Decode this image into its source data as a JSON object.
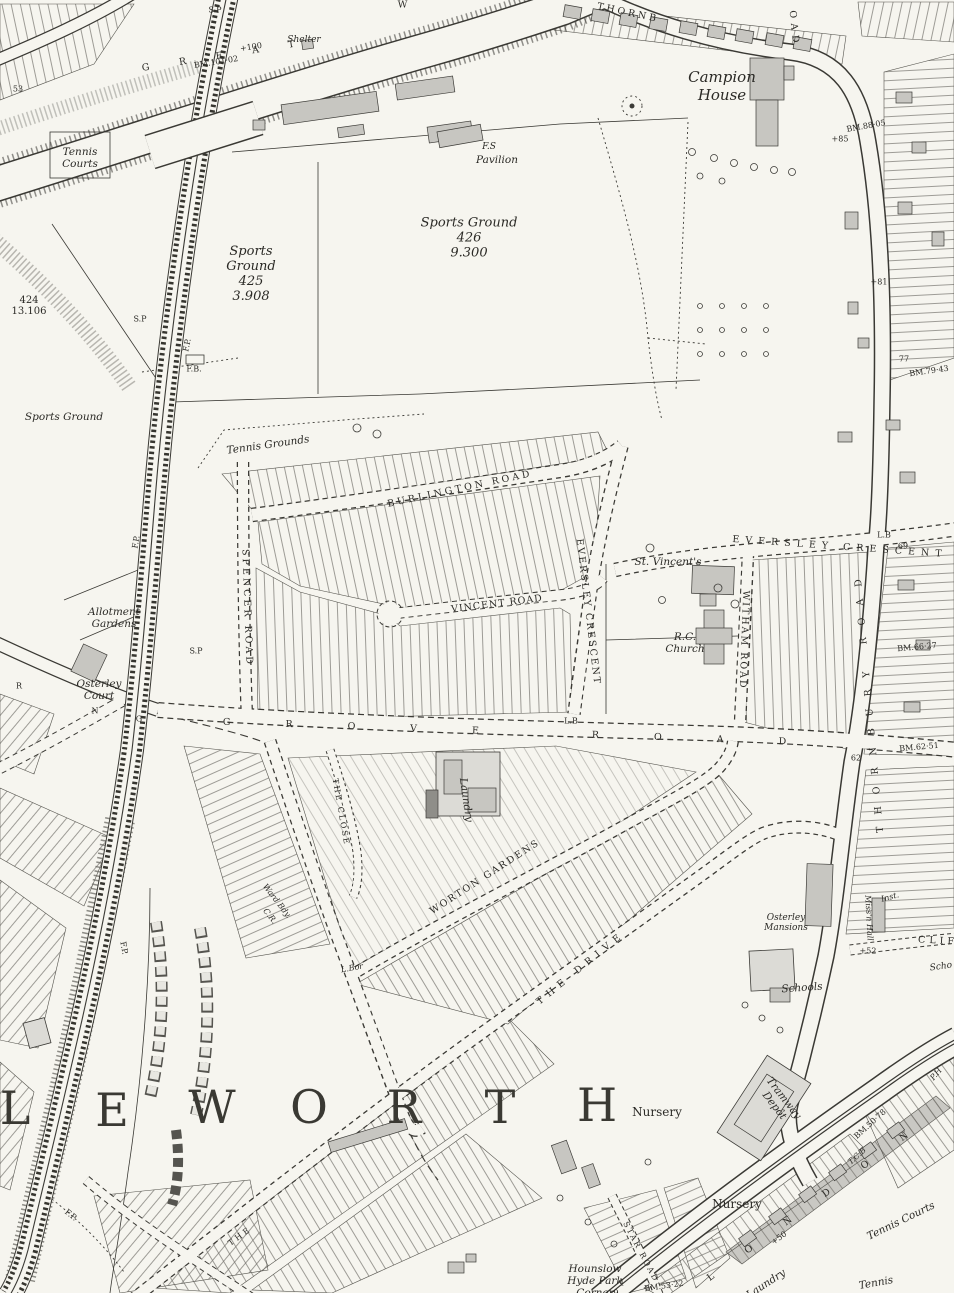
{
  "meta": {
    "kind": "historic-ordnance-survey-map",
    "area": "Isleworth / Osterley, Middlesex",
    "colors": {
      "paper": "#f6f5ef",
      "ink": "#33322e",
      "building_grey": "#c7c6c1",
      "building_light": "#dcdbd6",
      "plot_stripe": "#77756f"
    }
  },
  "labels": [
    {
      "id": "sp-top",
      "t": "S.P",
      "x": 215,
      "y": 10,
      "c": "sm"
    },
    {
      "id": "shelter",
      "t": "Shelter",
      "x": 304,
      "y": 40,
      "c": "itsm"
    },
    {
      "id": "great-west-road",
      "t": "GREAT",
      "x": 233,
      "y": 54,
      "r": -9,
      "c": "rd",
      "ls": 30
    },
    {
      "id": "great-west-road-w",
      "t": "W",
      "x": 404,
      "y": 5,
      "c": "rd"
    },
    {
      "id": "bm-101-02",
      "t": "BM.101·02",
      "x": 216,
      "y": 62,
      "r": -9,
      "c": "sm"
    },
    {
      "id": "spot-100",
      "t": "+100",
      "x": 251,
      "y": 47,
      "r": -9,
      "c": "sm"
    },
    {
      "id": "spot-53",
      "t": "53",
      "x": 18,
      "y": 89,
      "c": "sm"
    },
    {
      "id": "tennis-courts-nw",
      "t": "Tennis\nCourts",
      "x": 80,
      "y": 158,
      "c": "it"
    },
    {
      "id": "thornbury-road-top",
      "t": "THORNB",
      "x": 628,
      "y": 13,
      "r": 12,
      "c": "rd",
      "ls": 3
    },
    {
      "id": "campion-house",
      "t": "Campion\nHouse",
      "x": 722,
      "y": 86,
      "c": "itxl"
    },
    {
      "id": "thornbury-road-oad",
      "t": "OAD",
      "x": 794,
      "y": 29,
      "r": 84,
      "c": "rd",
      "ls": 5
    },
    {
      "id": "bm-88-05",
      "t": "BM.88·05",
      "x": 866,
      "y": 126,
      "r": -10,
      "c": "sm"
    },
    {
      "id": "spot-85",
      "t": "+85",
      "x": 840,
      "y": 139,
      "c": "sm"
    },
    {
      "id": "fs",
      "t": "F.S",
      "x": 489,
      "y": 147,
      "c": "itsm"
    },
    {
      "id": "pavilion",
      "t": "Pavilion",
      "x": 497,
      "y": 160,
      "c": "it"
    },
    {
      "id": "sports-ground-426",
      "t": "Sports Ground\n426\n9.300",
      "x": 469,
      "y": 238,
      "c": "itlg"
    },
    {
      "id": "sports-ground-425",
      "t": "Sports\nGround\n425\n3.908",
      "x": 251,
      "y": 274,
      "c": "itlg"
    },
    {
      "id": "parcel-424",
      "t": "424\n13.106",
      "x": 29,
      "y": 306,
      "c": "bksm"
    },
    {
      "id": "sp-rail",
      "t": "S.P",
      "x": 140,
      "y": 319,
      "c": "sm"
    },
    {
      "id": "fp-rail",
      "t": "F.P.",
      "x": 187,
      "y": 345,
      "r": -78,
      "c": "sm"
    },
    {
      "id": "fb-rail",
      "t": "F.B.",
      "x": 194,
      "y": 369,
      "c": "sm"
    },
    {
      "id": "spot-81",
      "t": "+81",
      "x": 879,
      "y": 282,
      "c": "sm"
    },
    {
      "id": "spot-77",
      "t": "77",
      "x": 904,
      "y": 359,
      "c": "sm"
    },
    {
      "id": "bm-79-43",
      "t": "BM.79·43",
      "x": 929,
      "y": 371,
      "r": -8,
      "c": "sm"
    },
    {
      "id": "sports-ground-w",
      "t": "Sports Ground",
      "x": 64,
      "y": 417,
      "c": "it"
    },
    {
      "id": "fp-rail-2",
      "t": "F.P.",
      "x": 136,
      "y": 542,
      "r": -80,
      "c": "sm"
    },
    {
      "id": "tennis-grounds",
      "t": "Tennis Grounds",
      "x": 268,
      "y": 445,
      "r": -8,
      "c": "it"
    },
    {
      "id": "burlington-road",
      "t": "BURLINGTON ROAD",
      "x": 460,
      "y": 489,
      "r": -12,
      "c": "rd",
      "ls": 3
    },
    {
      "id": "spencer-road",
      "t": "SPENCER ROAD",
      "x": 247,
      "y": 608,
      "r": 88,
      "c": "rd",
      "ls": 3
    },
    {
      "id": "vincent-road",
      "t": "VINCENT ROAD",
      "x": 497,
      "y": 604,
      "r": -7,
      "c": "rd",
      "ls": 1
    },
    {
      "id": "eversley-crescent-w",
      "t": "EVERSLEY CRESCENT",
      "x": 588,
      "y": 612,
      "r": 83,
      "c": "rd",
      "ls": 2
    },
    {
      "id": "st-vincents",
      "t": "St. Vincent's",
      "x": 668,
      "y": 562,
      "c": "it"
    },
    {
      "id": "eversley-crescent-e",
      "t": "EVERSLEY CRESCENT",
      "x": 840,
      "y": 547,
      "r": 4,
      "c": "rd",
      "ls": 6
    },
    {
      "id": "lb-crescent",
      "t": "L.B",
      "x": 884,
      "y": 535,
      "c": "sm"
    },
    {
      "id": "spot-69",
      "t": "69",
      "x": 903,
      "y": 546,
      "c": "sm"
    },
    {
      "id": "witham-road",
      "t": "WITHAM ROAD",
      "x": 744,
      "y": 640,
      "r": 92,
      "c": "rd",
      "ls": 2
    },
    {
      "id": "rc-church",
      "t": "R.C.\nChurch",
      "x": 685,
      "y": 643,
      "c": "it"
    },
    {
      "id": "bm-66-27",
      "t": "BM.66·27",
      "x": 917,
      "y": 647,
      "r": -5,
      "c": "sm"
    },
    {
      "id": "thornbury-road",
      "t": "THORNBURY ROAD",
      "x": 869,
      "y": 700,
      "r": -95,
      "c": "rd",
      "ls": 12
    },
    {
      "id": "grove-road",
      "t": "GROVE ROAD",
      "x": 532,
      "y": 733,
      "r": 2,
      "c": "rd",
      "ls": 55
    },
    {
      "id": "lb-grove",
      "t": "L.B",
      "x": 571,
      "y": 721,
      "c": "sm"
    },
    {
      "id": "sp-grove",
      "t": "S.P",
      "x": 196,
      "y": 651,
      "c": "sm"
    },
    {
      "id": "the-close",
      "t": "THE CLOSE",
      "x": 341,
      "y": 812,
      "r": 80,
      "c": "rdsm",
      "ls": 2
    },
    {
      "id": "laundry",
      "t": "Laundry",
      "x": 466,
      "y": 800,
      "r": 82,
      "c": "it"
    },
    {
      "id": "allotment-gardens",
      "t": "Allotment\nGardens",
      "x": 114,
      "y": 618,
      "c": "it"
    },
    {
      "id": "osterley-court",
      "t": "Osterley\nCourt",
      "x": 99,
      "y": 690,
      "c": "it"
    },
    {
      "id": "ward-bdy",
      "t": "Ward Bdy.",
      "x": 277,
      "y": 901,
      "r": 52,
      "c": "smi"
    },
    {
      "id": "cr",
      "t": "C.R.",
      "x": 270,
      "y": 916,
      "r": 52,
      "c": "smi"
    },
    {
      "id": "l-bor",
      "t": "L.Bor",
      "x": 352,
      "y": 968,
      "r": -10,
      "c": "smi"
    },
    {
      "id": "worton-gardens",
      "t": "WORTON GARDENS",
      "x": 485,
      "y": 877,
      "r": -33,
      "c": "rd",
      "ls": 2
    },
    {
      "id": "the-drive",
      "t": "THE DRIVE",
      "x": 581,
      "y": 968,
      "r": -39,
      "c": "rd",
      "ls": 6
    },
    {
      "id": "the-drive-sw",
      "t": "THE",
      "x": 240,
      "y": 1236,
      "r": -36,
      "c": "rdsm",
      "ls": 3
    },
    {
      "id": "district-l",
      "t": "L",
      "x": 15,
      "y": 1108,
      "c": "hg"
    },
    {
      "id": "district-e",
      "t": "E",
      "x": 112,
      "y": 1110,
      "c": "hg"
    },
    {
      "id": "district-w",
      "t": "W",
      "x": 212,
      "y": 1107,
      "c": "hg"
    },
    {
      "id": "district-o",
      "t": "O",
      "x": 309,
      "y": 1107,
      "c": "hg"
    },
    {
      "id": "district-r",
      "t": "R",
      "x": 404,
      "y": 1107,
      "c": "hg"
    },
    {
      "id": "district-t",
      "t": "T",
      "x": 500,
      "y": 1107,
      "c": "hg"
    },
    {
      "id": "district-h",
      "t": "H",
      "x": 597,
      "y": 1105,
      "c": "hg"
    },
    {
      "id": "nursery-n",
      "t": "Nursery",
      "x": 657,
      "y": 1112,
      "c": "bk"
    },
    {
      "id": "tramway-depot",
      "t": "Tramway\nDepôt",
      "x": 779,
      "y": 1102,
      "r": 52,
      "c": "it"
    },
    {
      "id": "nursery-s",
      "t": "Nursery",
      "x": 737,
      "y": 1204,
      "c": "bk"
    },
    {
      "id": "schools",
      "t": "Schools",
      "x": 802,
      "y": 988,
      "r": -4,
      "c": "it"
    },
    {
      "id": "osterley-mansions",
      "t": "Osterley\nMansions",
      "x": 786,
      "y": 923,
      "c": "itsm"
    },
    {
      "id": "missn-hall",
      "t": "Miss'n Hall",
      "x": 869,
      "y": 918,
      "r": 87,
      "c": "smi"
    },
    {
      "id": "inst",
      "t": "Inst.",
      "x": 890,
      "y": 897,
      "r": -15,
      "c": "smi"
    },
    {
      "id": "clifton-road",
      "t": "CLIF",
      "x": 938,
      "y": 941,
      "r": 3,
      "c": "rd",
      "ls": 4
    },
    {
      "id": "school-e",
      "t": "Scho",
      "x": 941,
      "y": 967,
      "r": -8,
      "c": "itsm"
    },
    {
      "id": "spot-52",
      "t": "+52",
      "x": 868,
      "y": 951,
      "c": "sm"
    },
    {
      "id": "bm-62-51",
      "t": "BM.62·51",
      "x": 919,
      "y": 747,
      "r": -5,
      "c": "sm"
    },
    {
      "id": "spot-62",
      "t": "62",
      "x": 856,
      "y": 758,
      "c": "sm"
    },
    {
      "id": "ph",
      "t": "P.H",
      "x": 936,
      "y": 1074,
      "r": -50,
      "c": "smi"
    },
    {
      "id": "bm-50-78",
      "t": "BM.50·78",
      "x": 870,
      "y": 1124,
      "r": -42,
      "c": "sm"
    },
    {
      "id": "tcb",
      "t": "T.C.B",
      "x": 857,
      "y": 1156,
      "r": -42,
      "c": "smi"
    },
    {
      "id": "london-road",
      "t": "LONDON",
      "x": 824,
      "y": 1195,
      "r": -36,
      "c": "rd",
      "ls": 40
    },
    {
      "id": "spot-50",
      "t": "+50",
      "x": 779,
      "y": 1238,
      "r": -36,
      "c": "sm"
    },
    {
      "id": "star-road",
      "t": "STAR ROAD",
      "x": 641,
      "y": 1252,
      "r": 62,
      "c": "rdsm",
      "ls": 2
    },
    {
      "id": "bm-53-22",
      "t": "BM.53·22",
      "x": 664,
      "y": 1286,
      "r": -8,
      "c": "sm"
    },
    {
      "id": "hounslow-hyde-park-corner",
      "t": "Hounslow\nHyde Park\nCorner",
      "x": 595,
      "y": 1281,
      "c": "it"
    },
    {
      "id": "number-1",
      "t": "1",
      "x": 622,
      "y": 1283,
      "c": "sm"
    },
    {
      "id": "number-9",
      "t": "9",
      "x": 616,
      "y": 1293,
      "c": "sm"
    },
    {
      "id": "tennis-courts-se",
      "t": "Tennis Courts",
      "x": 901,
      "y": 1221,
      "r": -26,
      "c": "it"
    },
    {
      "id": "tennis-courts-s",
      "t": "Tennis",
      "x": 876,
      "y": 1283,
      "r": -10,
      "c": "it"
    },
    {
      "id": "laundry-s",
      "t": "Laundry",
      "x": 766,
      "y": 1284,
      "r": -33,
      "c": "it"
    },
    {
      "id": "fp-sw",
      "t": "F.P.",
      "x": 71,
      "y": 1215,
      "r": 38,
      "c": "sm"
    },
    {
      "id": "fp-w",
      "t": "F.P.",
      "x": 124,
      "y": 948,
      "r": 80,
      "c": "sm"
    },
    {
      "id": "bdy-letter-n",
      "t": "N",
      "x": 95,
      "y": 711,
      "c": "sm"
    },
    {
      "id": "bdy-letter-g",
      "t": "G",
      "x": 139,
      "y": 719,
      "c": "sm"
    },
    {
      "id": "bdy-letter-r",
      "t": "R",
      "x": 19,
      "y": 686,
      "c": "sm"
    }
  ]
}
